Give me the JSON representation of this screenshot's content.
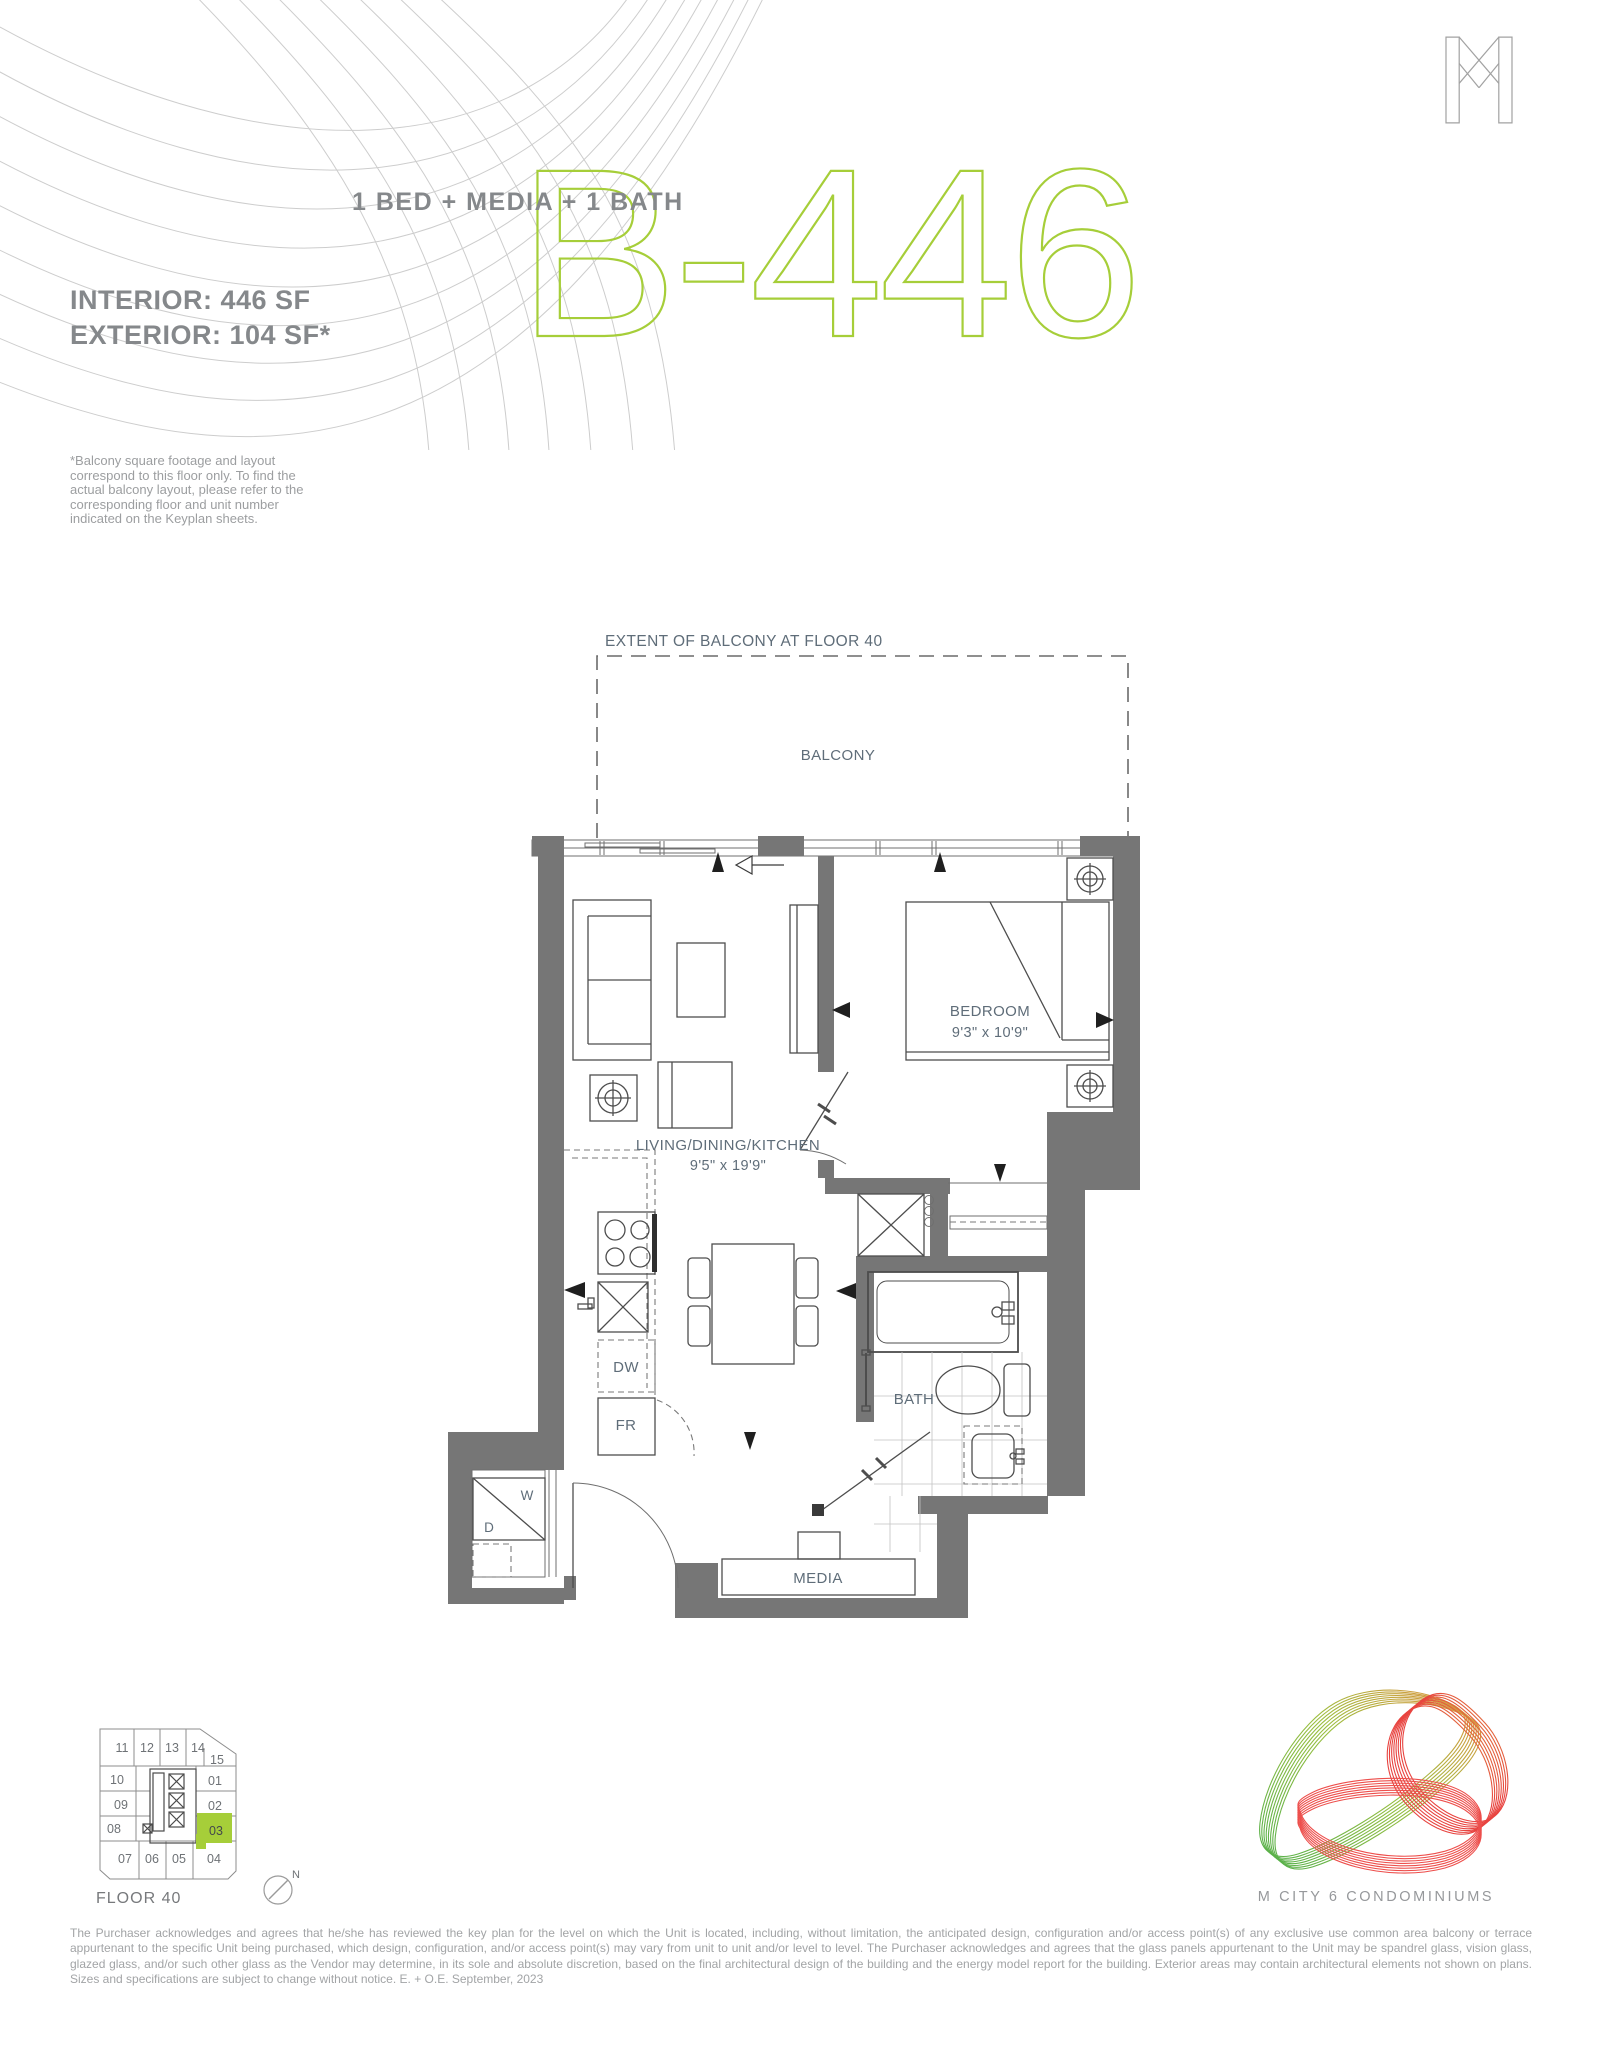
{
  "header": {
    "unit_type": "1 BED + MEDIA + 1 BATH",
    "unit_code": "B-446",
    "interior": "INTERIOR: 446 SF",
    "exterior": "EXTERIOR: 104 SF*",
    "balcony_note": "*Balcony square footage and layout correspond to this floor only. To find the actual balcony layout, please refer to the corresponding floor and unit number indicated on the Keyplan sheets."
  },
  "plan": {
    "extent_label": "EXTENT OF BALCONY AT FLOOR 40",
    "balcony_label": "BALCONY",
    "bedroom_label": "BEDROOM",
    "bedroom_dim": "9'3\" x 10'9\"",
    "living_label": "LIVING/DINING/KITCHEN",
    "living_dim": "9'5\" x 19'9\"",
    "bath_label": "BATH",
    "media_label": "MEDIA",
    "dw_label": "DW",
    "fr_label": "FR",
    "washer_label": "W",
    "dryer_label": "D"
  },
  "keyplan": {
    "floor_label": "FLOOR 40",
    "compass_label": "N",
    "highlighted_unit": "03",
    "units": [
      "11",
      "12",
      "13",
      "14",
      "15",
      "10",
      "01",
      "09",
      "02",
      "08",
      "03",
      "07",
      "06",
      "05",
      "04"
    ]
  },
  "footer": {
    "logo_title": "M CITY 6 CONDOMINIUMS",
    "disclaimer": "The Purchaser acknowledges and agrees that he/she has reviewed the key plan for the level on which the Unit is located, including, without limitation, the anticipated design, configuration and/or access point(s) of any exclusive use common area balcony or terrace appurtenant to the specific Unit being purchased, which design, configuration, and/or access point(s) may vary from unit to unit and/or level to level. The Purchaser acknowledges and agrees that the glass panels appurtenant to the Unit may be spandrel glass, vision glass, glazed glass, and/or such other glass as the Vendor may determine, in its sole and absolute discretion, based on the final architectural design of the building and the energy model report for the building. Exterior areas may contain architectural elements not shown on plans. Sizes and specifications are subject to change without notice. E. + O.E. September, 2023"
  },
  "colors": {
    "accent_green": "#a6ce39",
    "wall_gray": "#767676",
    "label_blue_gray": "#5f6d79"
  }
}
